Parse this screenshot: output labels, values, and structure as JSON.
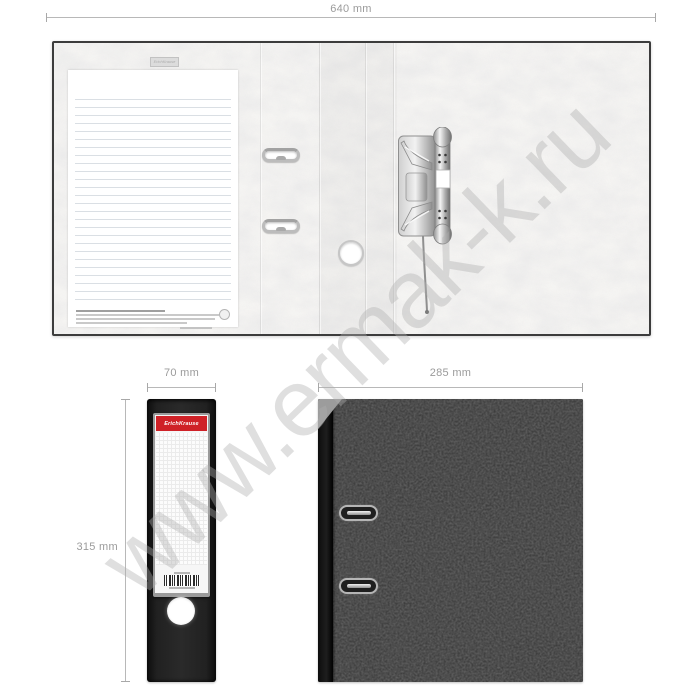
{
  "watermark": {
    "text": "www.ermak-k.ru"
  },
  "brand": {
    "name": "ErichKrause",
    "stamp": "ErichKrause"
  },
  "dimensions": {
    "open_width": "640 mm",
    "spine_width": "70 mm",
    "cover_width": "285 mm",
    "cover_height": "315 mm"
  },
  "colors": {
    "dimension_text": "#9b9b9b",
    "label_red": "#cf2127",
    "spine_black": "#1c1c1c",
    "cover_gray": "#3c3c3c",
    "interior_light": "#f2f1ef"
  }
}
